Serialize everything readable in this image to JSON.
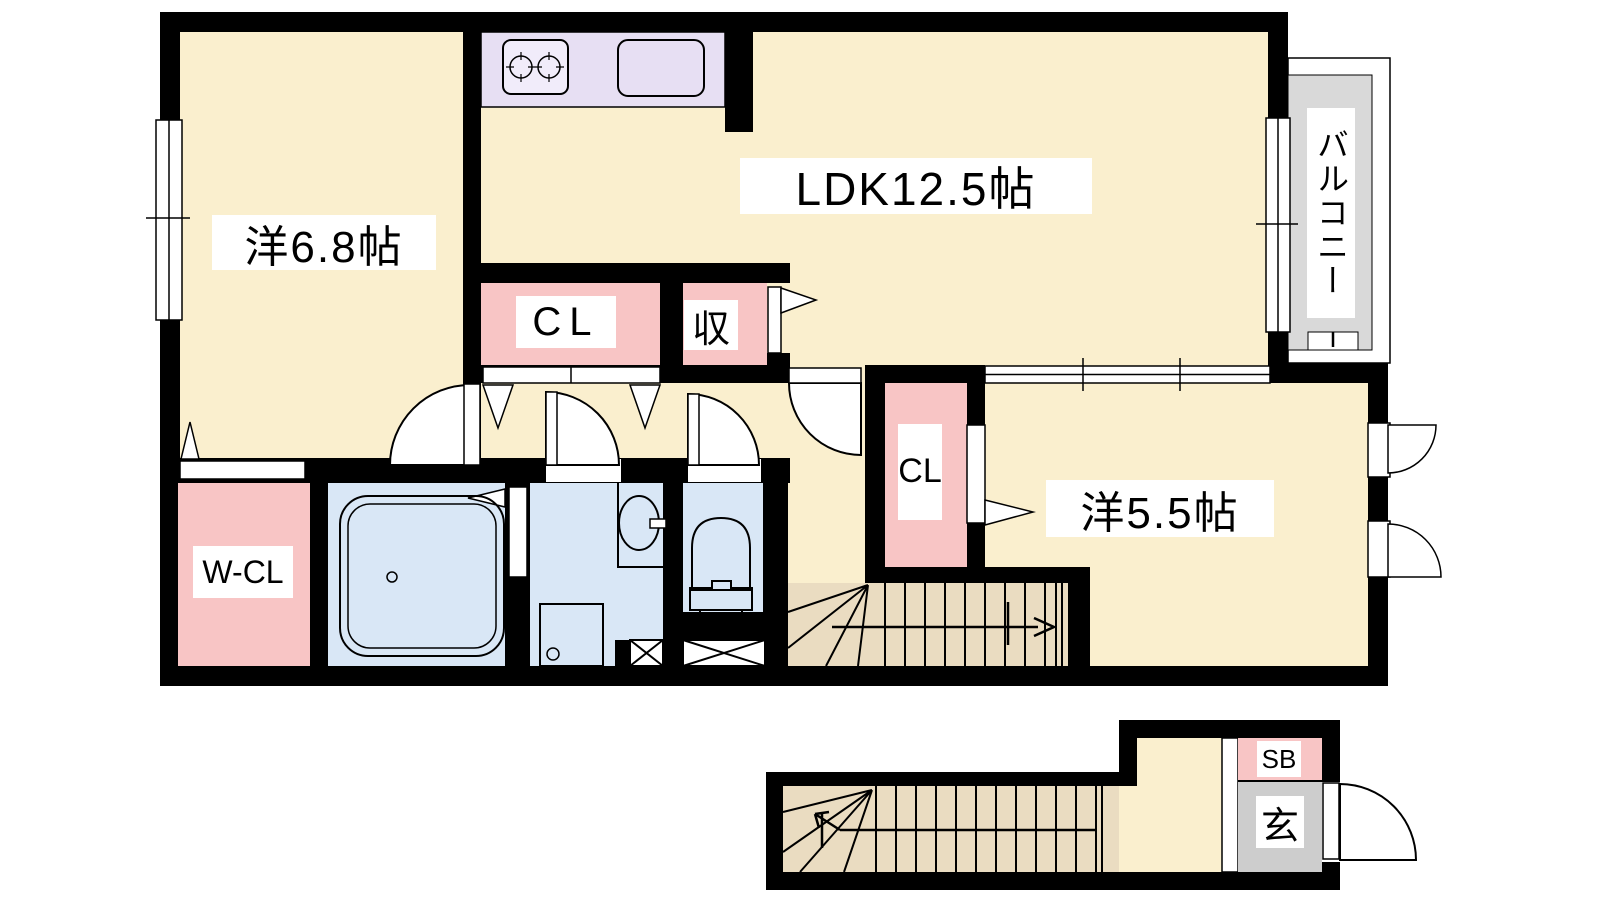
{
  "plan": {
    "type": "floor_plan",
    "floors": [
      {
        "name": "main-floor"
      },
      {
        "name": "entrance-floor"
      }
    ],
    "rooms": {
      "west_room_68": {
        "label": "洋6.8帖"
      },
      "ldk": {
        "label": "LDK12.5帖"
      },
      "closet_top": {
        "label": "CL"
      },
      "storage": {
        "label": "収"
      },
      "balcony": {
        "label": "バルコニー"
      },
      "closet_side": {
        "label": "CL"
      },
      "west_room_55": {
        "label": "洋5.5帖"
      },
      "walk_in_closet": {
        "label": "W-CL"
      },
      "shoe_box": {
        "label": "SB"
      },
      "entrance": {
        "label": "玄"
      }
    },
    "colors": {
      "wall": "#000000",
      "floor_cream": "#FAEFCE",
      "closet_pink": "#F8C5C5",
      "kitchen_purple": "#E7DFF3",
      "wet_room_blue": "#D9E7F6",
      "stairs_tan": "#EADCC1",
      "balcony_gray": "#D9D9D9",
      "entrance_gray": "#CDCDCD",
      "background": "#FFFFFF"
    }
  }
}
